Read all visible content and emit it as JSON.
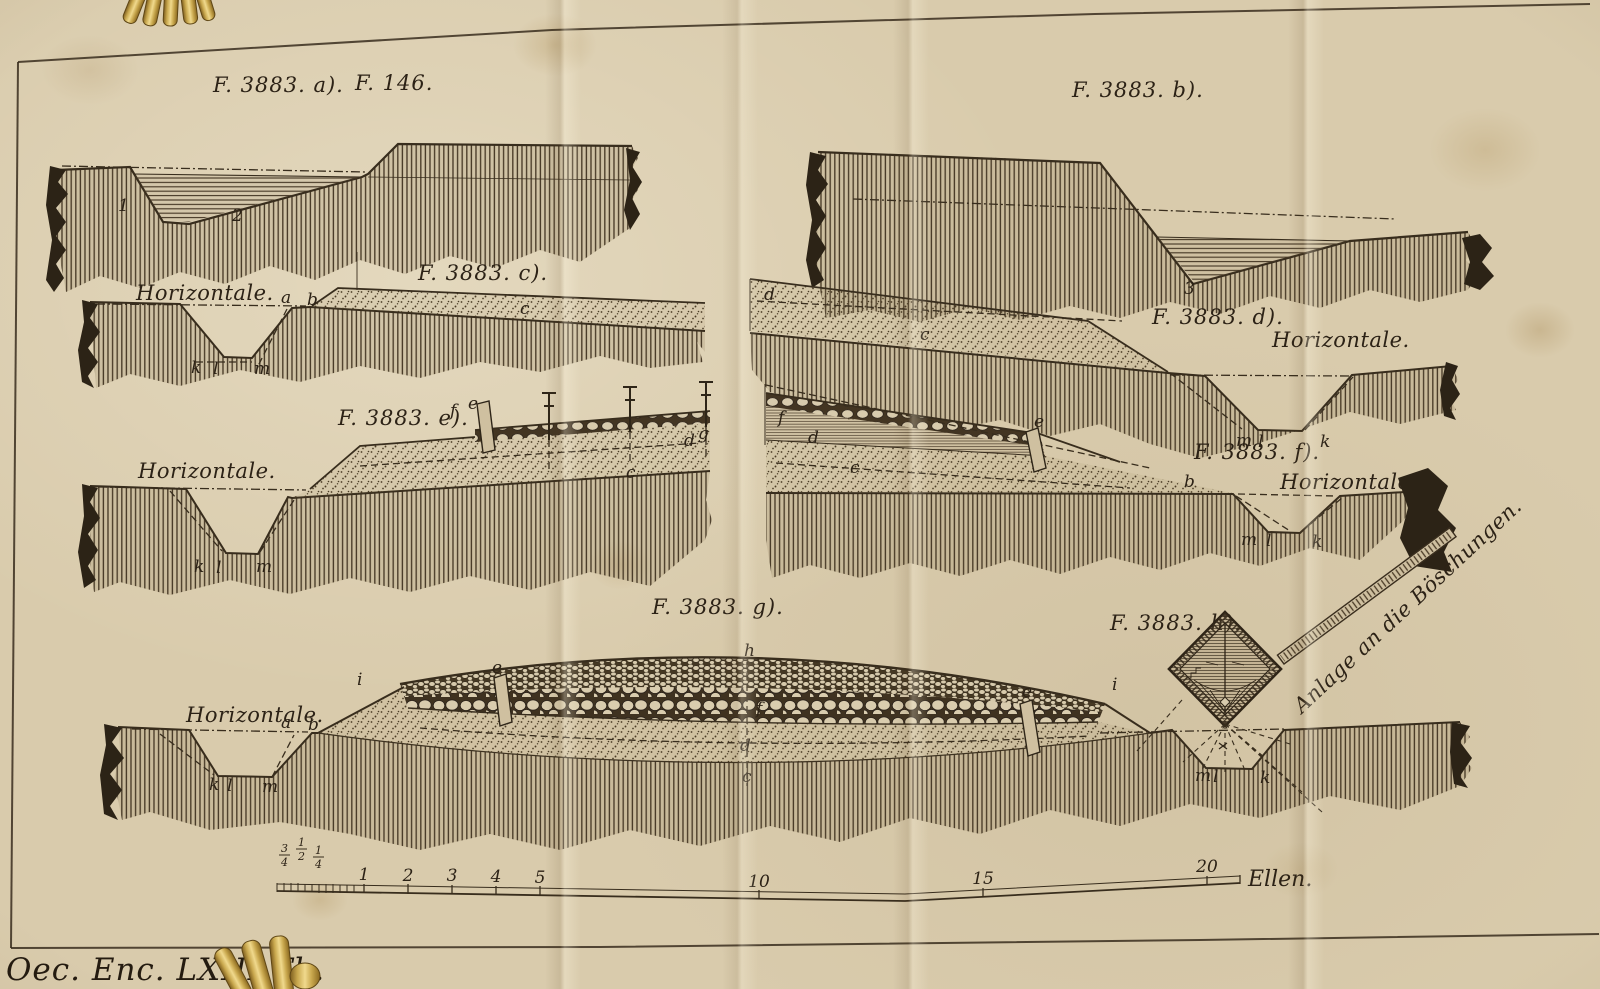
{
  "page": {
    "caption": "Oec. Enc. LXIII Th.",
    "paper_color": "#d9cbac",
    "ink_color": "#2c2216",
    "gold_color": "#c9a84e"
  },
  "figures": {
    "a": {
      "label": "F. 3883. a).",
      "label2": "F. 146.",
      "points": {
        "n1": "1",
        "n2": "2"
      }
    },
    "b": {
      "label": "F. 3883. b).",
      "points": {
        "n3": "3"
      }
    },
    "c": {
      "label": "F. 3883. c).",
      "horizontale": "Horizontale.",
      "points": {
        "a": "a",
        "b": "b",
        "c": "c",
        "k": "k",
        "l": "l",
        "m": "m"
      }
    },
    "d": {
      "label": "F. 3883. d).",
      "horizontale": "Horizontale.",
      "points": {
        "d": "d",
        "c": "c",
        "m": "m",
        "l": "l",
        "k": "k"
      }
    },
    "e": {
      "label": "F. 3883. e).",
      "horizontale": "Horizontale.",
      "points": {
        "f": "f",
        "e": "e",
        "d": "d",
        "g": "g",
        "c": "c",
        "k": "k",
        "l": "l",
        "m": "m"
      }
    },
    "f": {
      "label": "F. 3883. f).",
      "horizontale": "Horizontale.",
      "points": {
        "f": "f",
        "d": "d",
        "c": "c",
        "e": "e",
        "b": "b",
        "m": "m",
        "l": "l",
        "k": "k"
      }
    },
    "g": {
      "label": "F. 3883. g).",
      "horizontale": "Horizontale.",
      "points": {
        "a": "a",
        "b": "b",
        "i1": "i",
        "i2": "i",
        "h": "h",
        "f": "f",
        "d": "d",
        "c": "c",
        "e1": "e",
        "e2": "e",
        "k": "k",
        "l": "l",
        "m": "m"
      }
    },
    "h": {
      "label": "F. 3883. h).",
      "ruler_label": "Anlage an die Böschungen.",
      "points": {
        "m": "m",
        "l": "l",
        "k": "k"
      }
    }
  },
  "scale_bar": {
    "fractions": [
      {
        "n": "3",
        "d": "4"
      },
      {
        "n": "1",
        "d": "2"
      },
      {
        "n": "1",
        "d": "4"
      }
    ],
    "numbers": [
      "1",
      "2",
      "3",
      "4",
      "5",
      "10",
      "15",
      "20"
    ],
    "unit": "Ellen."
  }
}
